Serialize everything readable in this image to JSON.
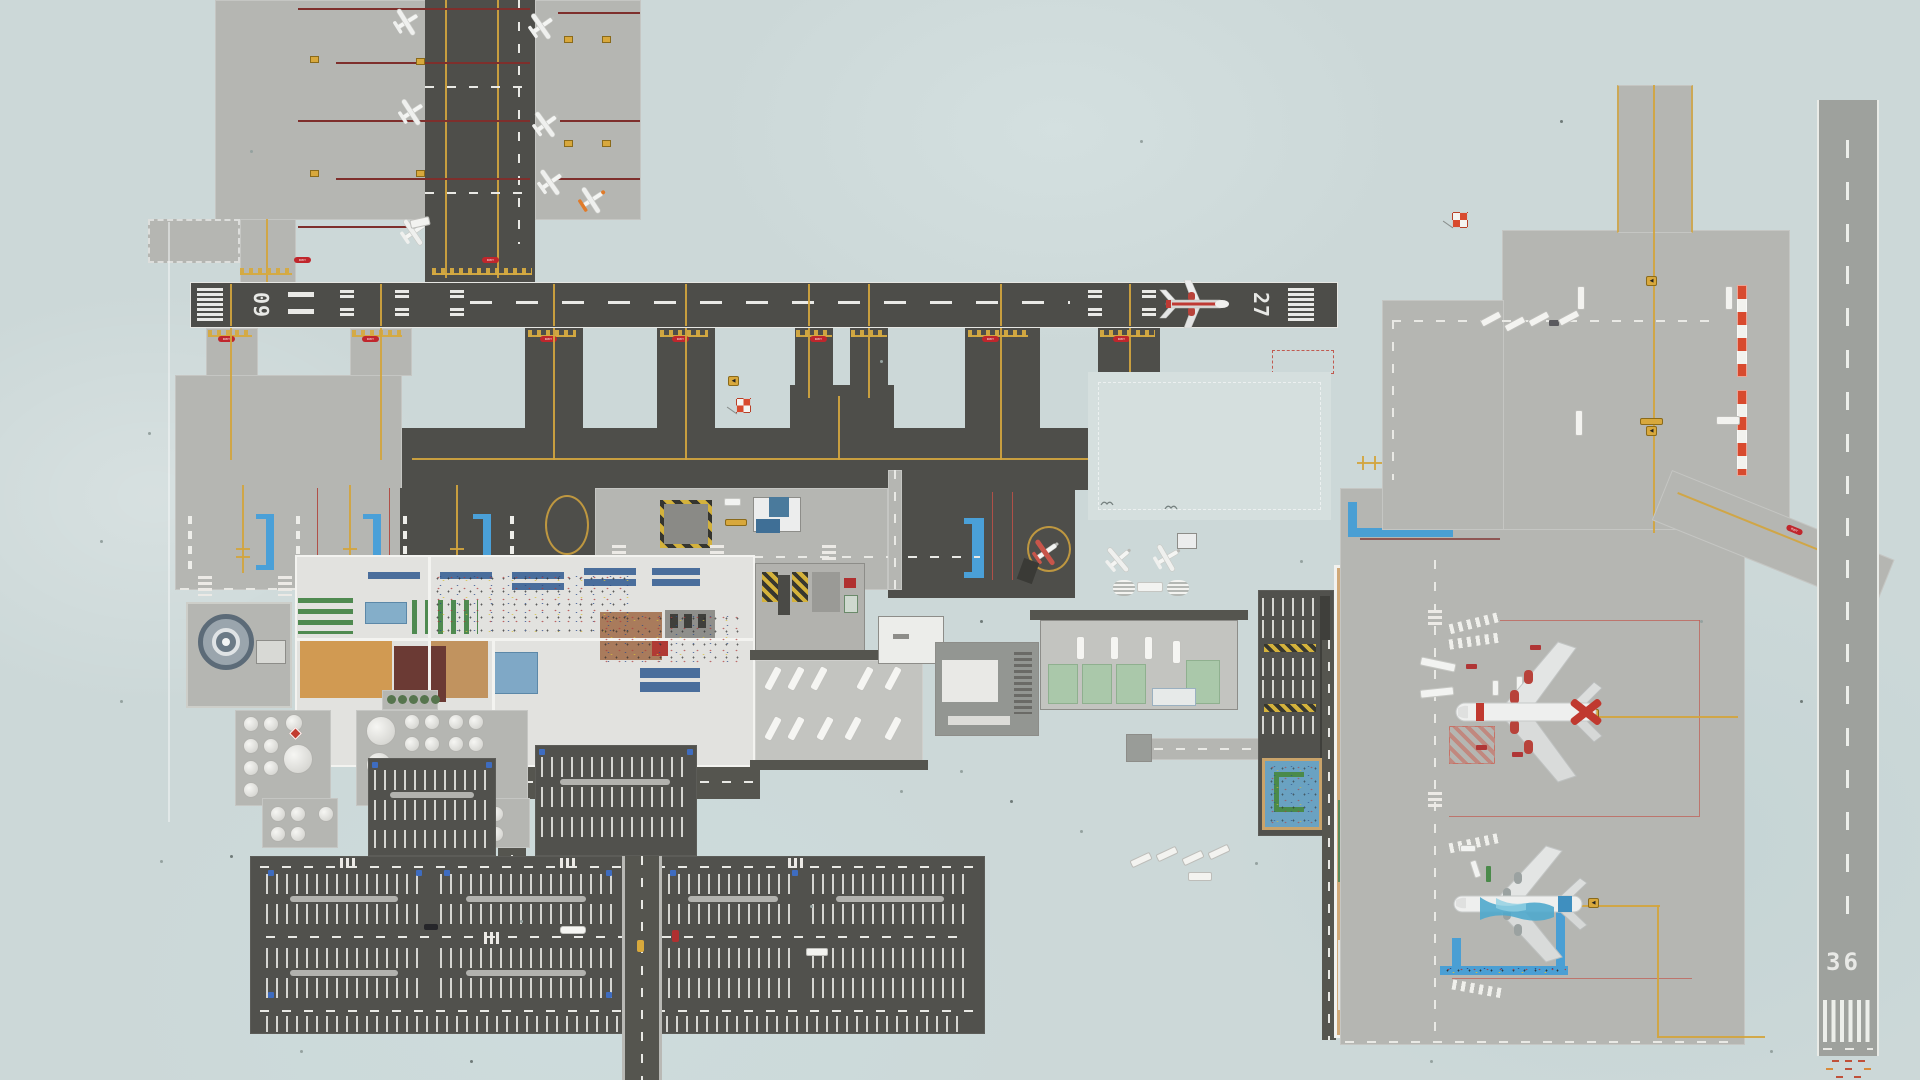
{
  "scene": {
    "description": "Top-down airport management game — full airport map overview, no HUD visible",
    "background": "#ccd8d8"
  },
  "runways": {
    "main": {
      "label_left": "09",
      "label_right": "27",
      "surface": "dark asphalt",
      "orientation": "east-west",
      "markings": [
        "threshold stripes",
        "aiming point bars",
        "touchdown zone bars",
        "dashed centerline"
      ]
    },
    "crosswind": {
      "label": "36",
      "surface": "light concrete",
      "orientation": "north-south",
      "markings": [
        "threshold stripes",
        "dashed centerline",
        "red-orange approach lights"
      ]
    }
  },
  "signs": {
    "hold_short": "RWY AHEAD",
    "taxi_arrow": "◀"
  },
  "windsocks": [
    {
      "id": "central",
      "style": "red-white checker"
    },
    {
      "id": "northeast",
      "style": "red-white checker"
    }
  ],
  "aircraft": [
    {
      "id": "airliner-on-runway",
      "type": "narrow-body airliner",
      "livery": "white with red stripe and red engines",
      "location": "runway 09/27 near 27 threshold",
      "heading": "east"
    },
    {
      "id": "widebody-red",
      "type": "wide-body airliner",
      "livery": "white with red nose band and red tail",
      "location": "east terminal gate stand",
      "heading": "west"
    },
    {
      "id": "widebody-blue",
      "type": "wide-body airliner",
      "livery": "white with blue wave pattern",
      "location": "east remote stand with walking path",
      "heading": "west"
    },
    {
      "id": "ga-white",
      "count": 6,
      "type": "light single-prop",
      "location": "northwest GA apron"
    },
    {
      "id": "ga-orange",
      "count": 1,
      "type": "light single-prop",
      "location": "northwest GA apron east edge"
    },
    {
      "id": "ga-red",
      "count": 1,
      "type": "light single-prop",
      "location": "central apron GA loop pad"
    },
    {
      "id": "ga-field",
      "count": 2,
      "type": "light single-prop",
      "location": "grass tie-down field east of terminal"
    }
  ],
  "ground_zones": [
    "northwest GA apron",
    "main terminal",
    "east security hall",
    "bus gate yard",
    "fuel farm",
    "radar site",
    "public parking lots",
    "grass tie-down field with red edge markers",
    "de-icing pads",
    "east passenger terminal",
    "remote wide-body stands",
    "northeast cargo apron with red-white edge markers",
    "vertical taxiway",
    "service roads with crosswalks"
  ],
  "palette": {
    "background": "#ccd8d8",
    "asphalt_dark": "#4e4e4a",
    "apron_gray": "#b5b6b2",
    "runway_concrete": "#9ea19d",
    "taxi_line_yellow": "#d2a53e",
    "hold_sign_red": "#c0262c",
    "stand_line_red": "#b05048",
    "jetbridge_blue": "#4aa0d8",
    "safety_hazard": "#d4b23c",
    "parking_lot": "#51514d",
    "terminal_floor": "#e2e2df",
    "grass_field": "#d5dfde"
  }
}
